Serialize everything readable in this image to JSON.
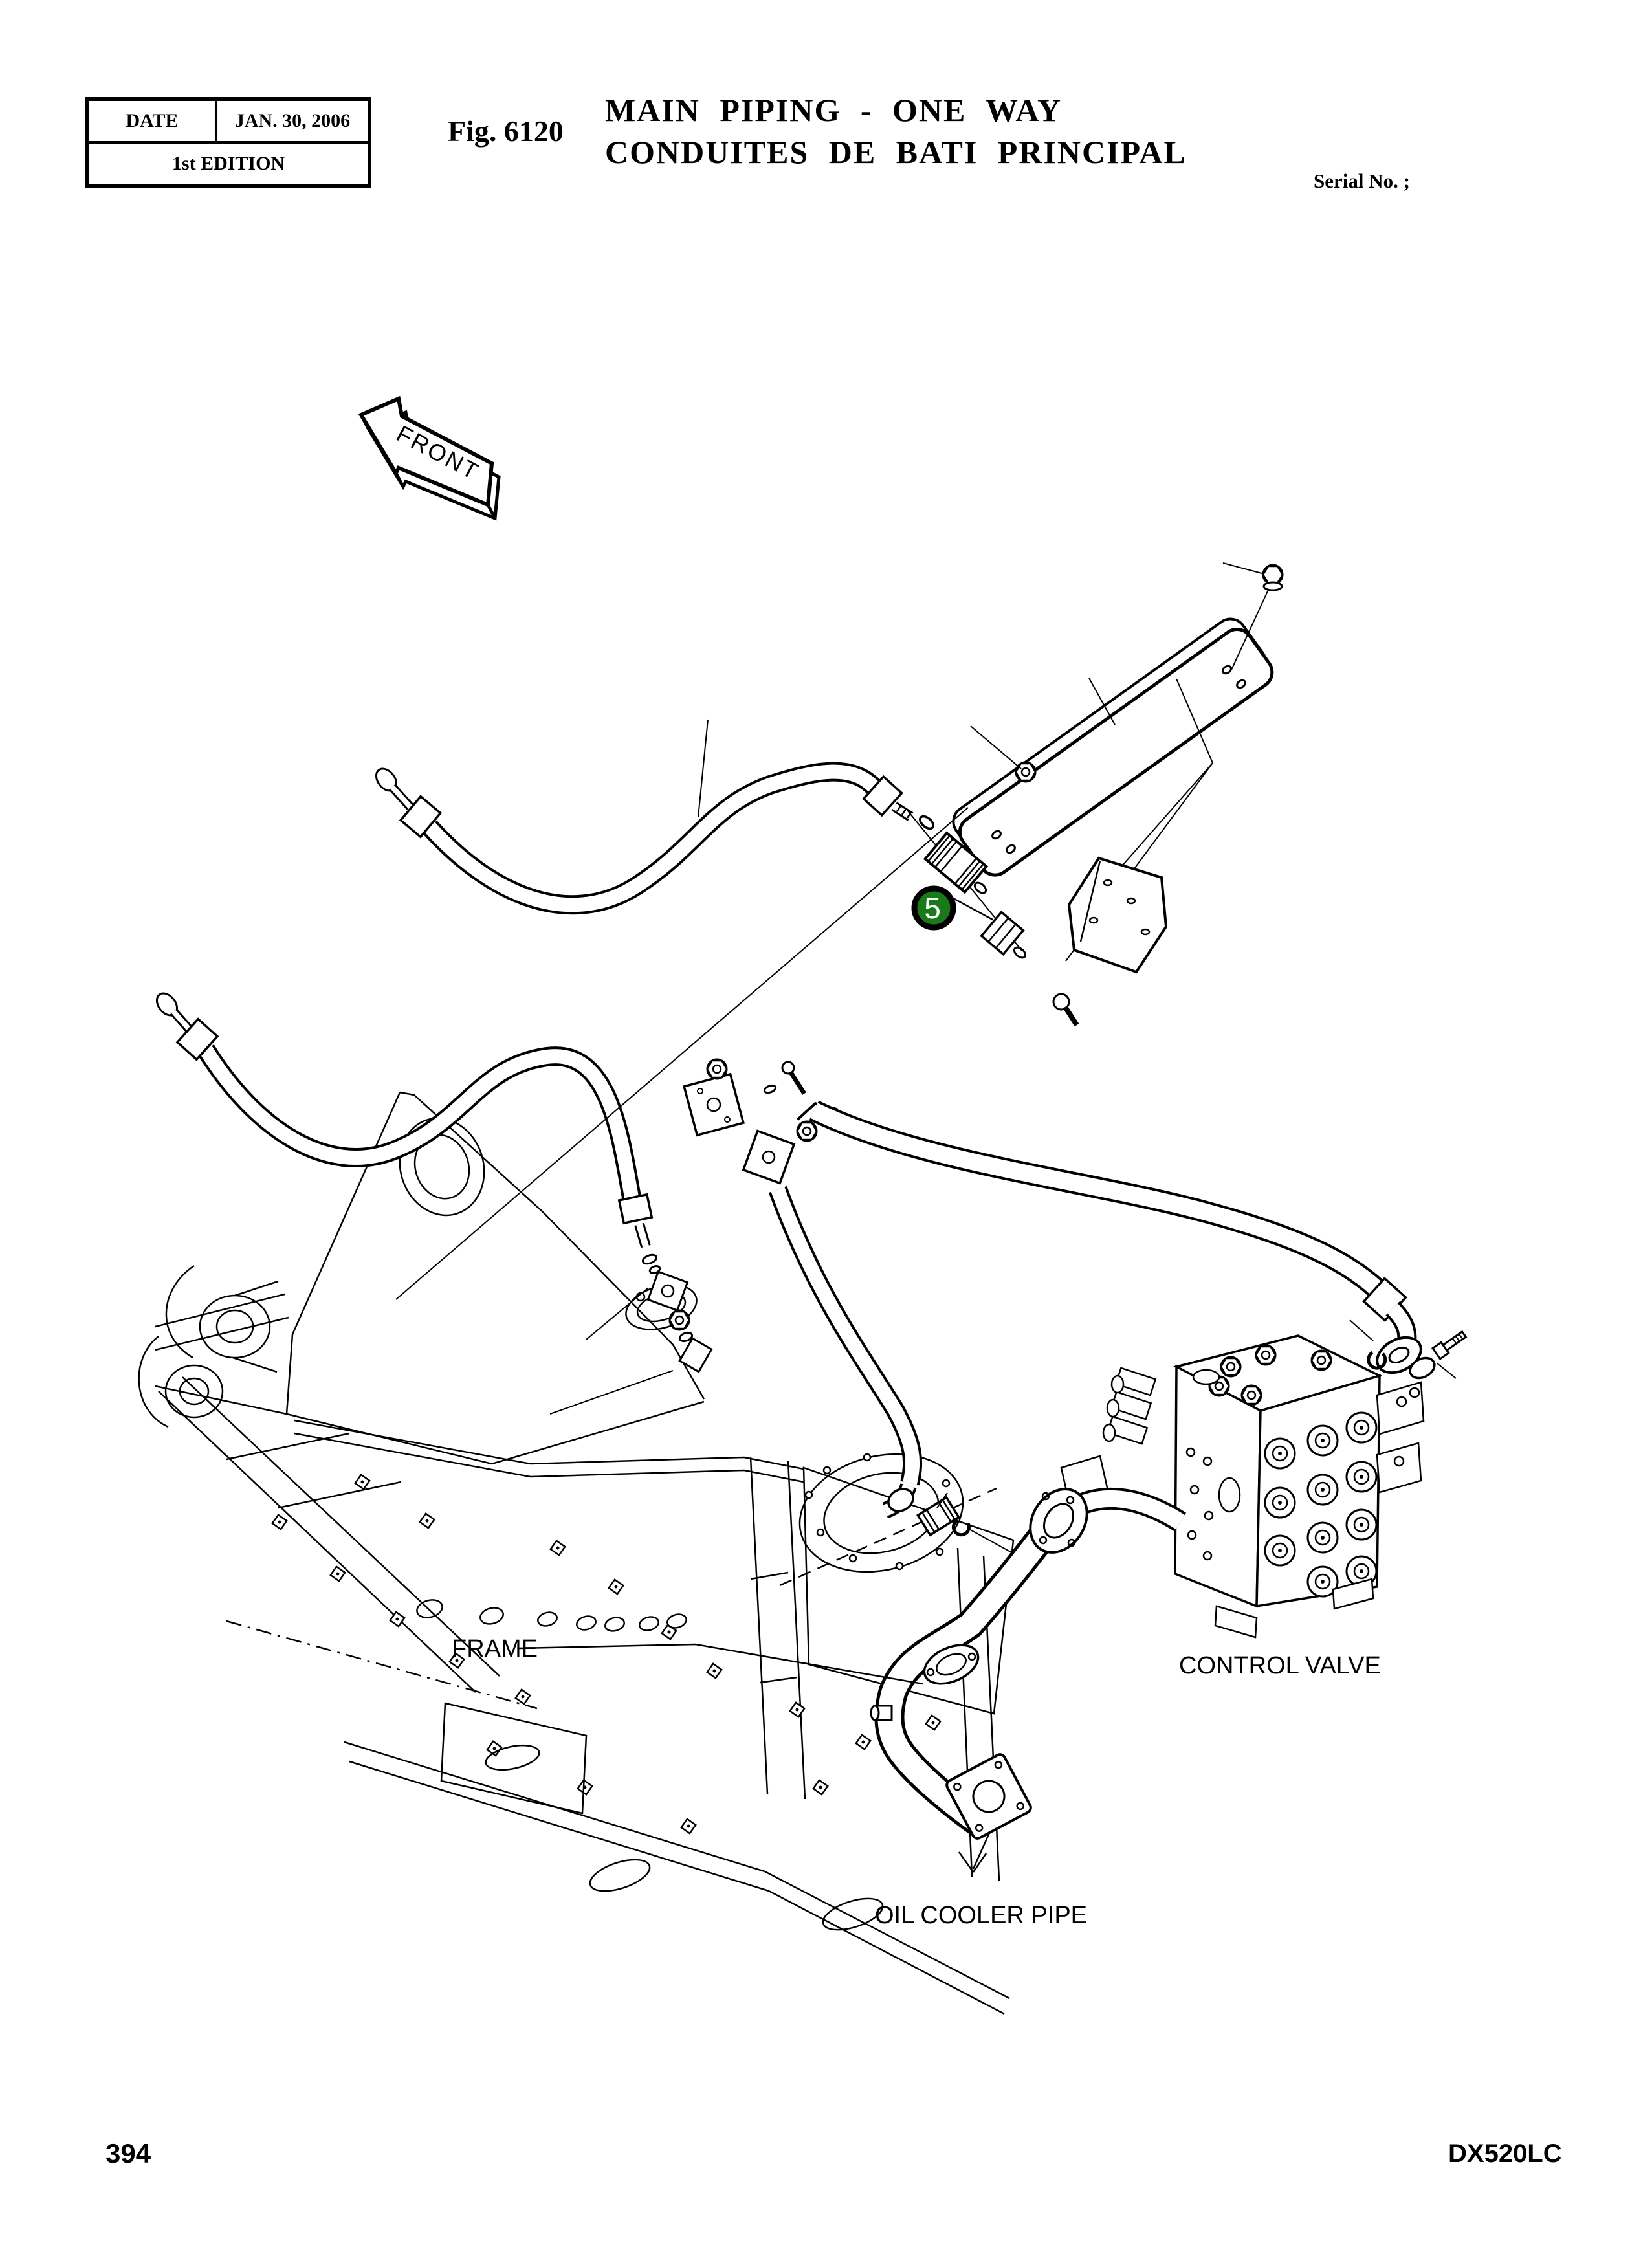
{
  "page": {
    "header": {
      "date_label": "DATE",
      "date_value": "JAN. 30, 2006",
      "edition": "1st EDITION",
      "figure_label": "Fig. 6120",
      "title_line1": "MAIN PIPING - ONE WAY",
      "title_line2": "CONDUITES DE BATI PRINCIPAL",
      "serial": "Serial No. ;"
    },
    "diagram": {
      "front_arrow_label": "FRONT",
      "callout_number": "5",
      "labels": {
        "frame": "FRAME",
        "control_valve": "CONTROL VALVE",
        "oil_cooler_pipe": "OIL COOLER PIPE"
      }
    },
    "footer": {
      "page_number": "394",
      "model_code": "DX520LC"
    }
  },
  "colors": {
    "callout_green": "#1a7a1a",
    "line_black": "#000000",
    "paper_white": "#ffffff"
  }
}
